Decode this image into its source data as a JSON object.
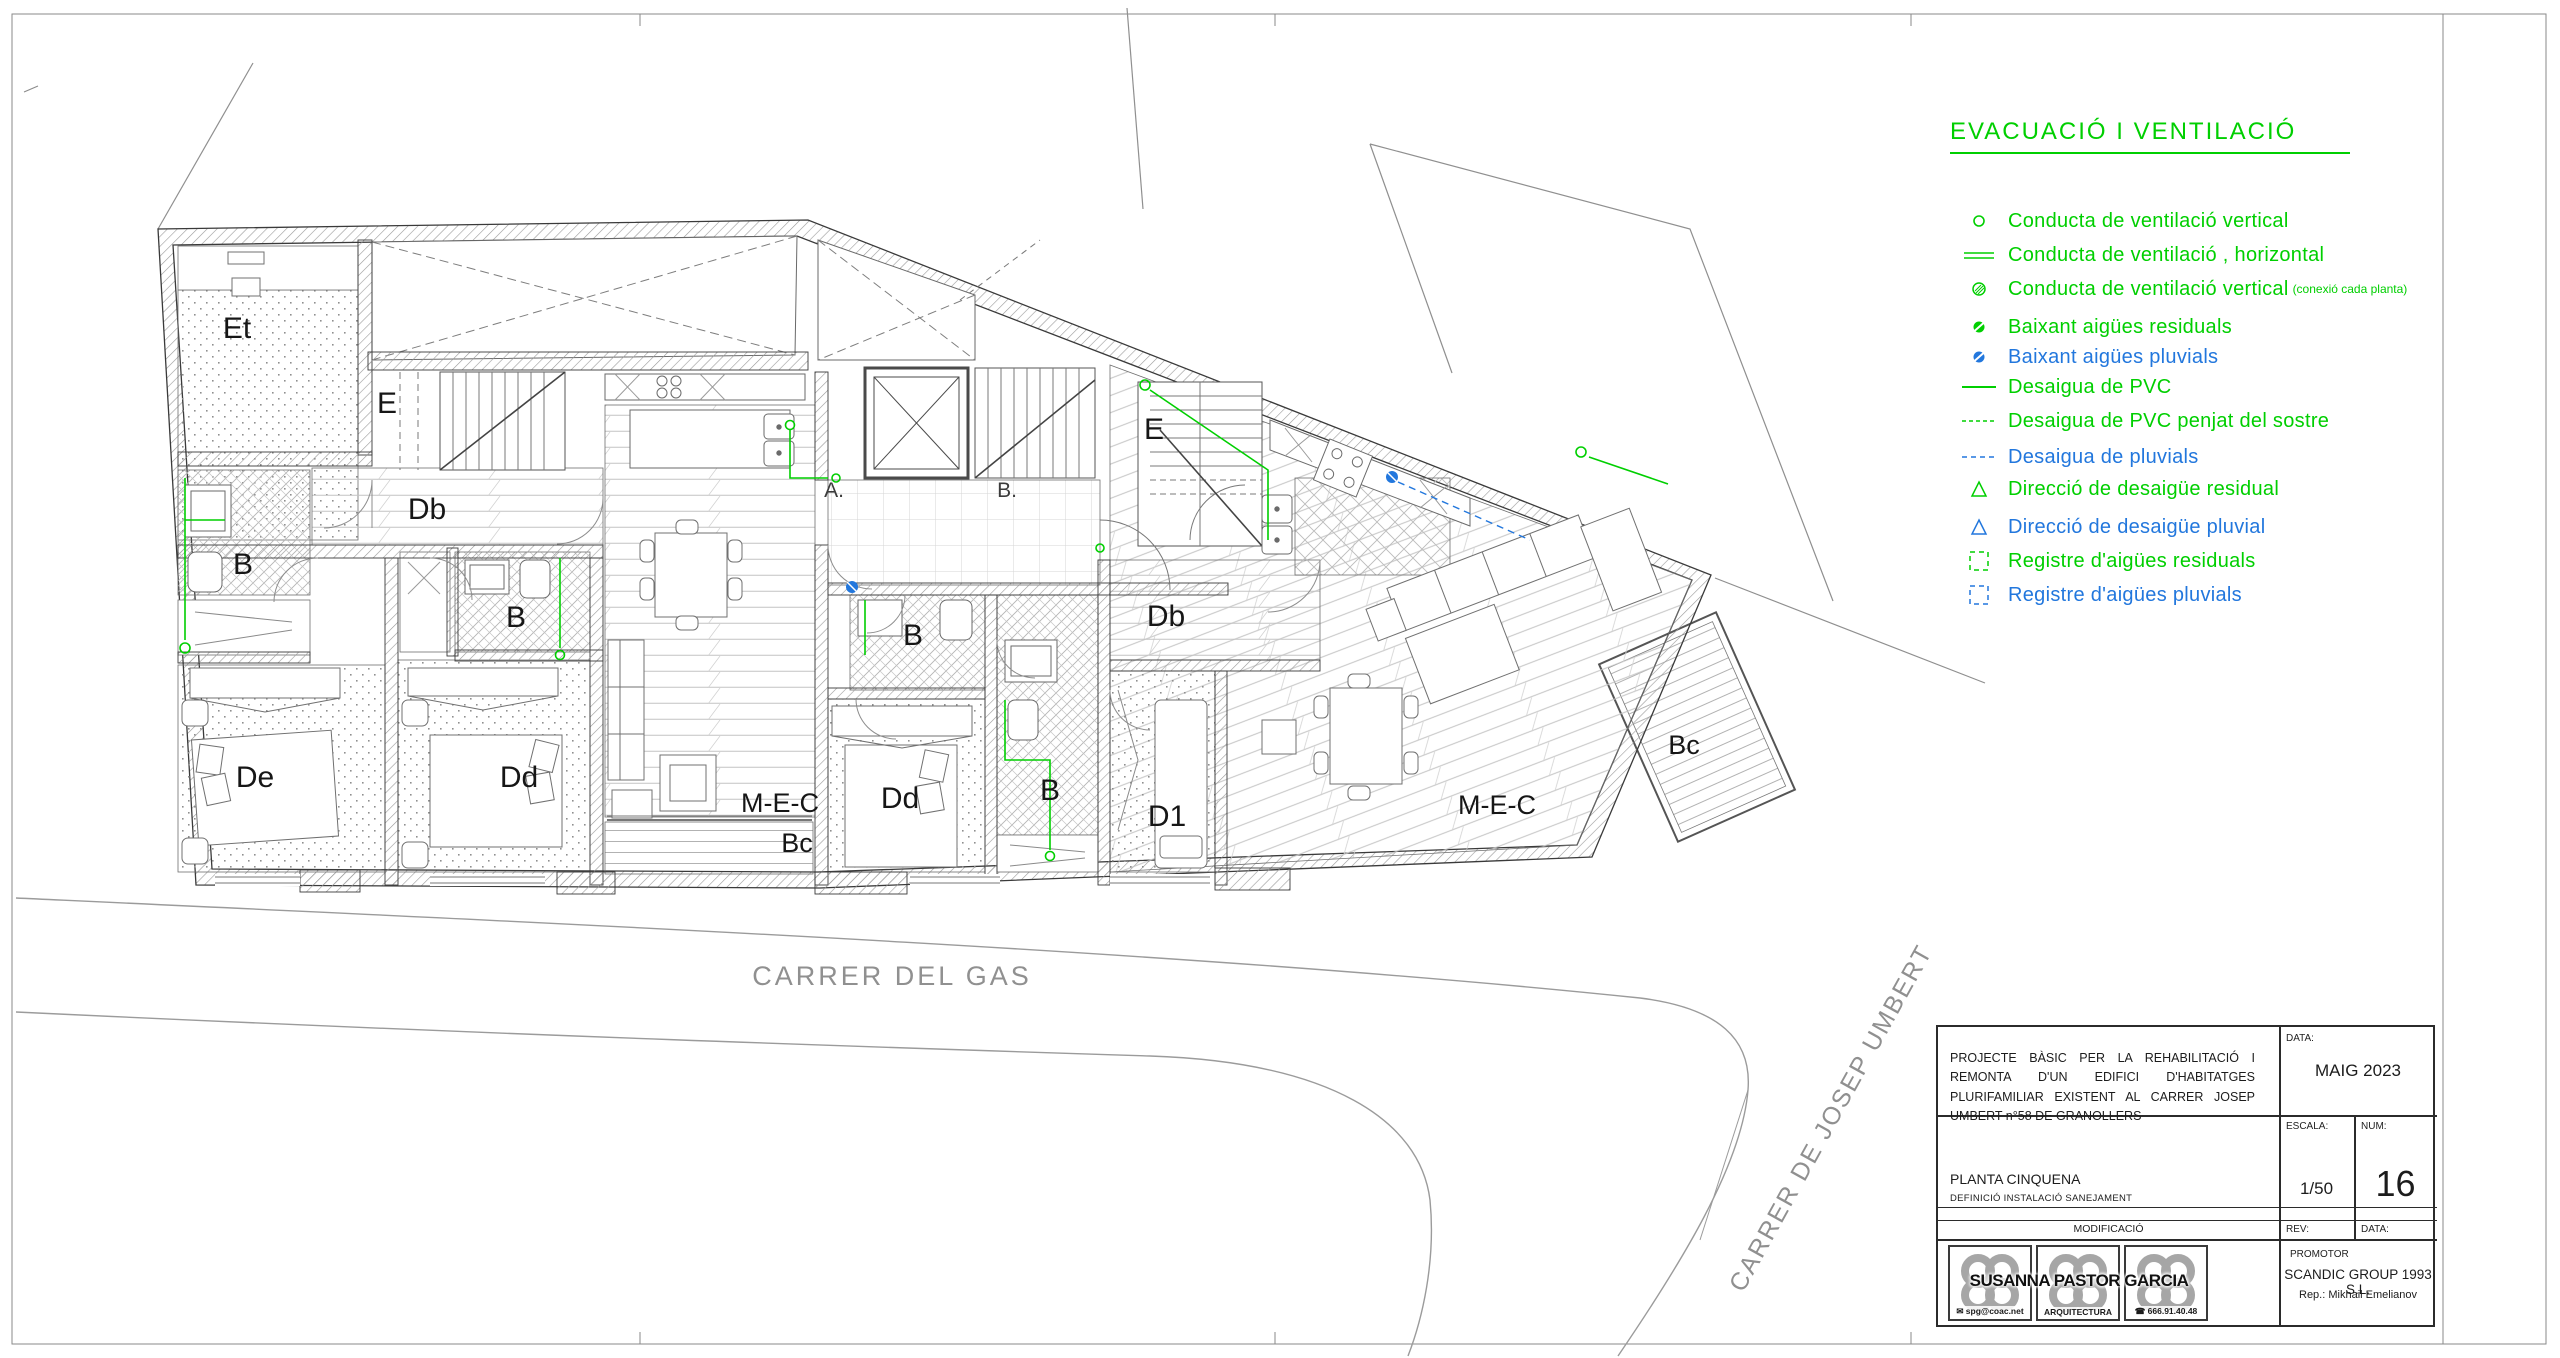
{
  "colors": {
    "green": "#00cf00",
    "blue": "#2277dd",
    "wall": "#3a3a3a",
    "street_text": "#909090"
  },
  "legend": {
    "title": "EVACUACIÓ I  VENTILACIÓ",
    "items": [
      {
        "icon": "vent-circle-icon",
        "color": "green",
        "label": "Conducta de ventilació vertical"
      },
      {
        "icon": "vent-horizontal-icon",
        "color": "green",
        "label": "Conducta de ventilació , horizontal"
      },
      {
        "icon": "vent-circle-hatched-icon",
        "color": "green",
        "label": "Conducta de ventilació vertical",
        "note": "(conexió cada planta)"
      },
      {
        "icon": "downpipe-residual-icon",
        "color": "green",
        "label": "Baixant aigües residuals"
      },
      {
        "icon": "downpipe-pluvial-icon",
        "color": "blue",
        "label": "Baixant aigües pluvials"
      },
      {
        "icon": "pvc-line-icon",
        "color": "green",
        "label": "Desaigua de PVC"
      },
      {
        "icon": "pvc-dashed-line-icon",
        "color": "green",
        "label": "Desaigua de PVC penjat del sostre"
      },
      {
        "icon": "pluvial-dashed-line-icon",
        "color": "blue",
        "label": "Desaigua de pluvials"
      },
      {
        "icon": "direction-residual-icon",
        "color": "green",
        "label": "Direcció de desaigüe residual"
      },
      {
        "icon": "direction-pluvial-icon",
        "color": "blue",
        "label": "Direcció de desaigüe pluvial"
      },
      {
        "icon": "register-residual-icon",
        "color": "green",
        "label": "Registre d'aigües residuals"
      },
      {
        "icon": "register-pluvial-icon",
        "color": "blue",
        "label": "Registre d'aigües pluvials"
      }
    ]
  },
  "title_block": {
    "project_text": "PROJECTE BÀSIC PER LA REHABILITACIÓ I REMONTA D'UN EDIFICI D'HABITATGES PLURIFAMILIAR EXISTENT AL CARRER JOSEP UMBERT n°58 DE GRANOLLERS",
    "data_label": "DATA:",
    "data_value": "MAIG 2023",
    "plan_title": "PLANTA CINQUENA",
    "plan_subtitle": "DEFINICIÓ INSTALACIÓ SANEJAMENT",
    "escala_label": "ESCALA:",
    "escala_value": "1/50",
    "num_label": "NUM:",
    "num_value": "16",
    "modificacio_label": "MODIFICACIÓ",
    "rev_label": "REV:",
    "data2_label": "DATA:",
    "promotor_label": "PROMOTOR",
    "promotor_name": "SCANDIC GROUP 1993 S.L.",
    "promotor_rep": "Rep.: Mikhail Emelianov",
    "logo": {
      "name": "SUSANNA PASTOR GARCIA",
      "email": "spg@coac.net",
      "dept": "ARQUITECTURA",
      "phone": "666.91.40.48"
    }
  },
  "plan": {
    "streets": {
      "gas": "CARRER DEL GAS",
      "umbert": "CARRER DE JOSEP UMBERT"
    },
    "labels": [
      {
        "id": "et",
        "text": "Et"
      },
      {
        "id": "e-left",
        "text": "E"
      },
      {
        "id": "db-left",
        "text": "Db"
      },
      {
        "id": "b-left",
        "text": "B"
      },
      {
        "id": "b-left2",
        "text": "B"
      },
      {
        "id": "de",
        "text": "De"
      },
      {
        "id": "dd-left",
        "text": "Dd"
      },
      {
        "id": "mec-left",
        "text": "M-E-C"
      },
      {
        "id": "bc-left",
        "text": "Bc"
      },
      {
        "id": "a-point",
        "text": "A."
      },
      {
        "id": "b-point",
        "text": "B."
      },
      {
        "id": "b-mid",
        "text": "B"
      },
      {
        "id": "dd-mid",
        "text": "Dd"
      },
      {
        "id": "b-mid2",
        "text": "B"
      },
      {
        "id": "d1",
        "text": "D1"
      },
      {
        "id": "e-right",
        "text": "E"
      },
      {
        "id": "db-right",
        "text": "Db"
      },
      {
        "id": "mec-right",
        "text": "M-E-C"
      },
      {
        "id": "bc-right",
        "text": "Bc"
      }
    ]
  }
}
